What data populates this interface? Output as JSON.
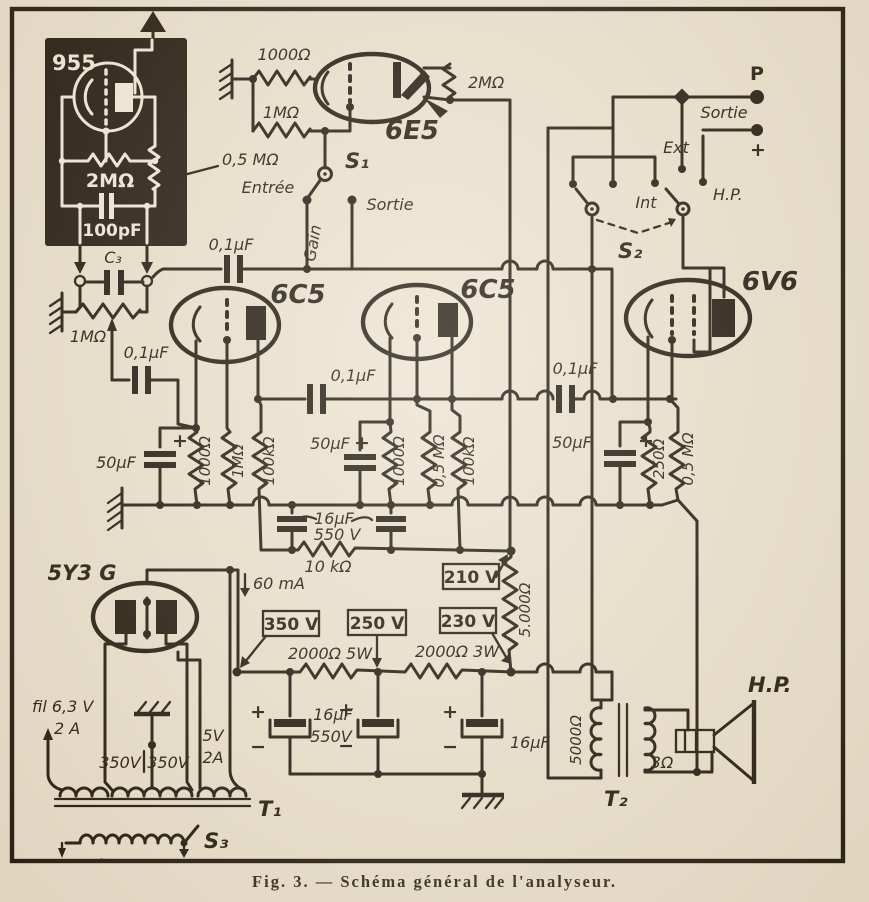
{
  "probe": {
    "tube": "955",
    "r_grid": "2MΩ",
    "c_grid": "100pF",
    "pot": "0,5 MΩ",
    "c3": "C₃",
    "pot2": "1MΩ"
  },
  "eye": {
    "r_cathode": "1000Ω",
    "r_grid": "1MΩ",
    "tube": "6E5",
    "r_plate": "2MΩ",
    "s1": "S₁",
    "entree": "Entrée",
    "sortie": "Sortie",
    "gain": "Gain"
  },
  "output": {
    "p": "P",
    "sortie": "Sortie",
    "plus": "+",
    "ext": "Ext",
    "int": "Int",
    "hp": "H.P.",
    "s2": "S₂"
  },
  "amp": {
    "v1": "6C5",
    "v2": "6C5",
    "v3": "6V6",
    "c_in": "0,1µF",
    "c_k1": "0,1µF",
    "c_c12": "0,1µF",
    "c_c23": "0,1µF",
    "c_k1b": "50µF",
    "c_k2b": "50µF",
    "c_k3b": "50µF",
    "plus1": "+",
    "plus2": "+",
    "plus3": "+",
    "r1k_1": "1000Ω",
    "r1m_1": "1MΩ",
    "r100k_1": "100kΩ",
    "r1k_2": "1000Ω",
    "r05m_2": "0,5 MΩ",
    "r100k_2": "100kΩ",
    "r250": "250Ω",
    "r05m_3": "0,5 MΩ"
  },
  "filter": {
    "c16": "16µF",
    "v550": "550 V",
    "r10k": "10 kΩ",
    "r5000": "5.000Ω"
  },
  "volts": {
    "v210": "210 V",
    "v350": "350 V",
    "v250": "250 V",
    "v230": "230 V"
  },
  "psu": {
    "tube": "5Y3 G",
    "i60": "60 mA",
    "r5w": "2000Ω 5W",
    "r3w": "2000Ω 3W",
    "ca_plus": "+",
    "ca_minus": "−",
    "cab": "16µF",
    "cab_v": "550V",
    "cb_plus": "+",
    "cb_minus": "−",
    "cc_plus": "+",
    "cc_minus": "−",
    "cc": "16µF",
    "fil": "fil 6,3 V",
    "fil_a": "2 A",
    "w350a": "350V",
    "w350b": "350V",
    "w5v": "5V",
    "w5a": "2A",
    "t1": "T₁",
    "ac": "~",
    "s3": "S₃"
  },
  "out_stage": {
    "r_prim": "5000Ω",
    "t2": "T₂",
    "z": "3Ω",
    "hp": "H.P."
  },
  "caption": "Fig.  3.  —  Schéma  général  de  l'analyseur."
}
